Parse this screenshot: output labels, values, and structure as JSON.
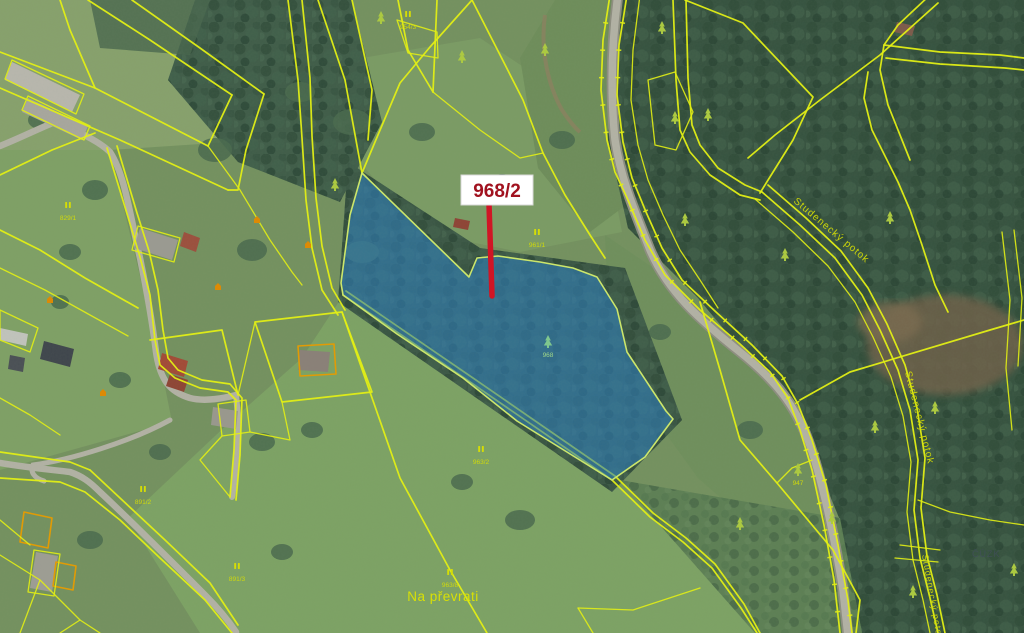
{
  "map": {
    "highlight": {
      "parcel_label": "968/2",
      "parcel_number": "968"
    },
    "place_label": "Na převrati",
    "stream_label": "Studenecký potok",
    "watermark": "ČÚZK",
    "parcel_numbers": [
      {
        "text": "961/1"
      },
      {
        "text": "963/2"
      },
      {
        "text": "963/8"
      },
      {
        "text": "891/2"
      },
      {
        "text": "829/1"
      },
      {
        "text": "954/3"
      },
      {
        "text": "891/3"
      },
      {
        "text": "947"
      }
    ],
    "colors": {
      "boundary_yellow": "#e6f211",
      "highlight_fill": "#2d7fc0",
      "highlight_label_text": "#a1121f",
      "leader_red": "#d01525",
      "map_label_yellow": "#d9e000",
      "watermark_grey": "#3e4c58"
    }
  }
}
